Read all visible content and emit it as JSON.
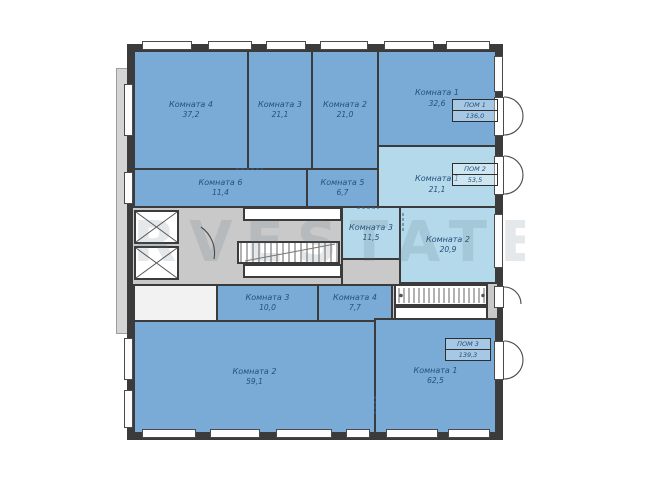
{
  "title": "Floor plan",
  "watermark": "RVESTATE",
  "colors": {
    "room_fill_dark": "#79abd6",
    "room_fill_light": "#b3d9ea",
    "corridor_gray": "#c9c9c9",
    "wall": "#3b3b3b",
    "label_text": "#24507c",
    "background": "#ffffff"
  },
  "units": [
    {
      "label": "ПОМ 1",
      "area": "136,0"
    },
    {
      "label": "ПОМ 2",
      "area": "53,5"
    },
    {
      "label": "ПОМ 3",
      "area": "139,3"
    }
  ],
  "rooms": [
    {
      "name": "Комната 4",
      "area": "37,2"
    },
    {
      "name": "Комната 3",
      "area": "21,1"
    },
    {
      "name": "Комната 2",
      "area": "21,0"
    },
    {
      "name": "Комната 1",
      "area": "32,6"
    },
    {
      "name": "Комната 6",
      "area": "11,4"
    },
    {
      "name": "Комната 5",
      "area": "6,7"
    },
    {
      "name": "Комната 1",
      "area": "21,1"
    },
    {
      "name": "Комната 3",
      "area": "11,5"
    },
    {
      "name": "Комната 2",
      "area": "20,9"
    },
    {
      "name": "Комната 3",
      "area": "10,0"
    },
    {
      "name": "Комната 4",
      "area": "7,7"
    },
    {
      "name": "Комната 2",
      "area": "59,1"
    },
    {
      "name": "Комната 1",
      "area": "62,5"
    }
  ]
}
